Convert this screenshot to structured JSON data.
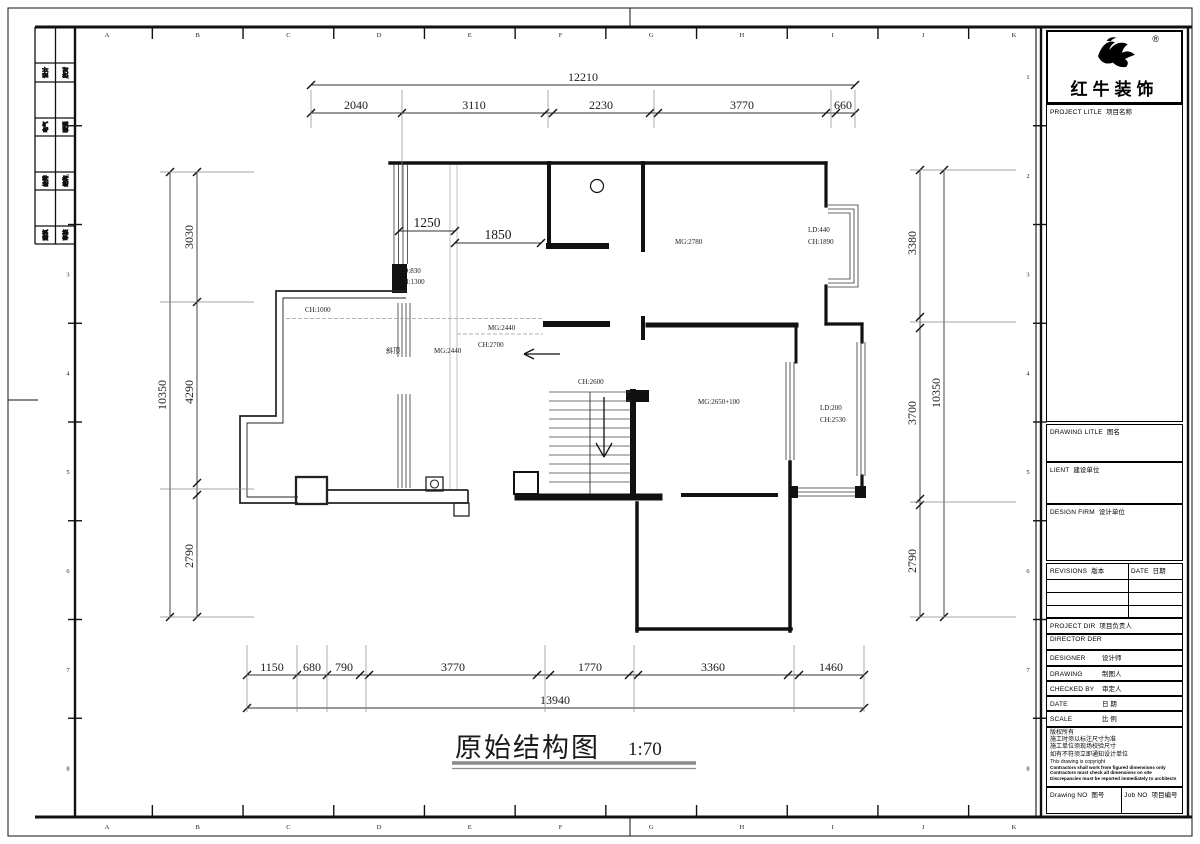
{
  "sheet": {
    "grid_cols": [
      "A",
      "B",
      "C",
      "D",
      "E",
      "F",
      "G",
      "H",
      "I",
      "J",
      "K"
    ],
    "grid_rows": [
      "1",
      "2",
      "3",
      "4",
      "5",
      "6",
      "7",
      "8"
    ],
    "signoff_cells": [
      "设计",
      "校对",
      "电气",
      "暖通",
      "给排",
      "结构",
      "建筑",
      "审核"
    ]
  },
  "logo": {
    "brand": "红牛装饰",
    "sub": "HONG NIU DECORATION",
    "reg": "®"
  },
  "title_block": {
    "project_en": "PROJECT LITLE",
    "project_cn": "项目名称",
    "drawing_title_en": "DRAWING LITLE",
    "drawing_title_cn": "图名",
    "client_en": "LIENT",
    "client_cn": "建设单位",
    "design_firm_en": "DESIGN FIRM",
    "design_firm_cn": "设计单位",
    "revisions_en": "REVISIONS",
    "revisions_cn": "版本",
    "rev_date_en": "DATE",
    "rev_date_cn": "日期",
    "project_dir_en": "PROJECT DIR",
    "project_dir_cn": "项目负责人",
    "director_en": "DIRECTOR DER",
    "designer_en": "DESIGNER",
    "designer_cn": "设计师",
    "drawing_by_en": "DRAWING",
    "drawing_by_cn": "制图人",
    "checked_en": "CHECKED BY",
    "checked_cn": "审定人",
    "date_en": "DATE",
    "date_cn": "日  期",
    "scale_en": "SCALE",
    "scale_cn": "比  例",
    "copyright_lines": [
      "版权所有",
      "施工时须以标注尺寸为准",
      "施工单位须现场校验尺寸",
      "如有不符须立即通知设计单位"
    ],
    "copyright_en": "This drawing is copyright",
    "copyright_bold": [
      "Contractors shall work from figured dimensions only",
      "Contractors must check all dimensions on site",
      "Discrepancies must be reported immediately to architects"
    ],
    "drawing_no_en": "Drawing NO",
    "drawing_no_cn": "图号",
    "job_no_en": "Job NO",
    "job_no_cn": "项目编号"
  },
  "plan": {
    "title": "原始结构图",
    "scale": "1:70",
    "dims": {
      "top_overall": "12210",
      "top_segments": [
        "2040",
        "3110",
        "2230",
        "3770",
        "660"
      ],
      "bottom_segments": [
        "1150",
        "680",
        "790",
        "3770",
        "1770",
        "3360",
        "1460"
      ],
      "bottom_overall": "13940",
      "left_segments": [
        "3030",
        "4290",
        "2790"
      ],
      "left_overall": "10350",
      "right_segments": [
        "3380",
        "3700",
        "2790"
      ],
      "right_overall": "10350",
      "inner": [
        "1250",
        "1850"
      ]
    },
    "labels": [
      "CH:1000",
      "LD:830",
      "CH:1300",
      "斜顶",
      "MG:2440",
      "MG:2440",
      "CH:2700",
      "CH:2600",
      "MG:2780",
      "LD:440",
      "CH:1890",
      "MG:2650+100",
      "LD:200",
      "CH:2530"
    ]
  }
}
